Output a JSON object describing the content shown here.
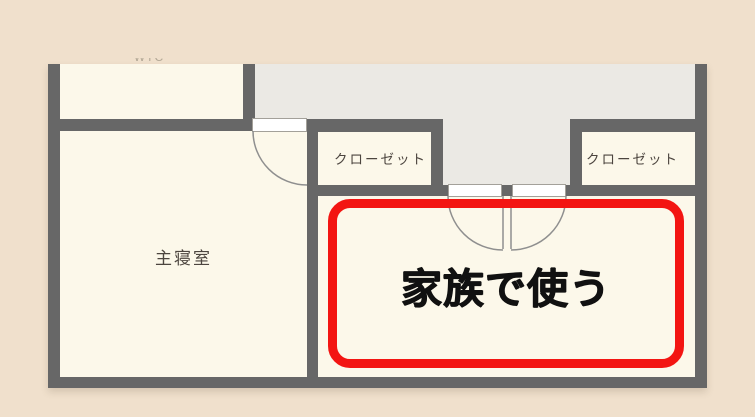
{
  "floorplan": {
    "master_bedroom_label": "主寝室",
    "closet_left_label": "クローゼット",
    "closet_right_label": "クローゼット",
    "cutoff_room_label": "WIC",
    "annotation_label": "家族で使う"
  },
  "colors": {
    "background": "#f0e0cc",
    "room_fill": "#fcf8ea",
    "hallway_fill": "#ebe9e4",
    "wall": "#676767",
    "door_arc": "#8f8f8f",
    "highlight_red": "#f31512",
    "room_label_text": "#4c453f",
    "annotation_text": "#111111"
  }
}
